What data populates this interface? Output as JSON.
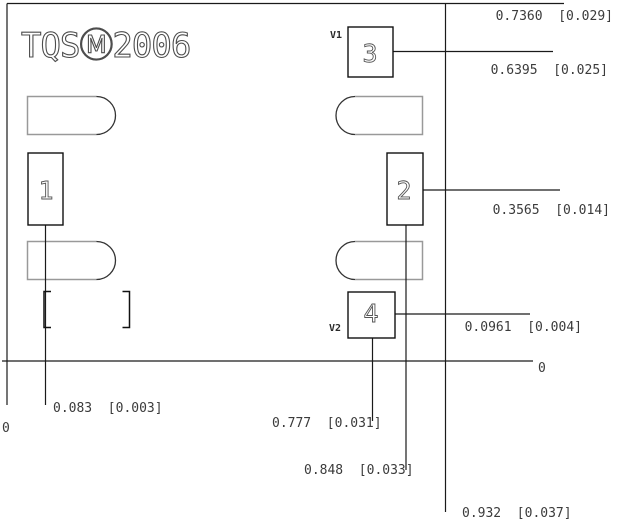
{
  "drawing": {
    "logo": {
      "text": "TQSⓂ2006"
    },
    "pins": {
      "p1": "1",
      "p2": "2",
      "p3": "3",
      "p4": "4"
    },
    "vias": {
      "v1": "V1",
      "v2": "V2"
    },
    "dims": {
      "d736": "0.7360  [0.029]",
      "d6395": "0.6395  [0.025]",
      "d3565": "0.3565  [0.014]",
      "d0961": "0.0961  [0.004]",
      "zero_right": "0",
      "d083": "0.083  [0.003]",
      "zero_left": "0",
      "d777": "0.777  [0.031]",
      "d848": "0.848  [0.033]",
      "d932": "0.932  [0.037]"
    },
    "colors": {
      "line": "#1a1a1a",
      "pad_outline": "#999999",
      "pad_arc": "#333333",
      "text": "#3b3b3b",
      "logo_stroke": "#4d4d4d"
    }
  }
}
